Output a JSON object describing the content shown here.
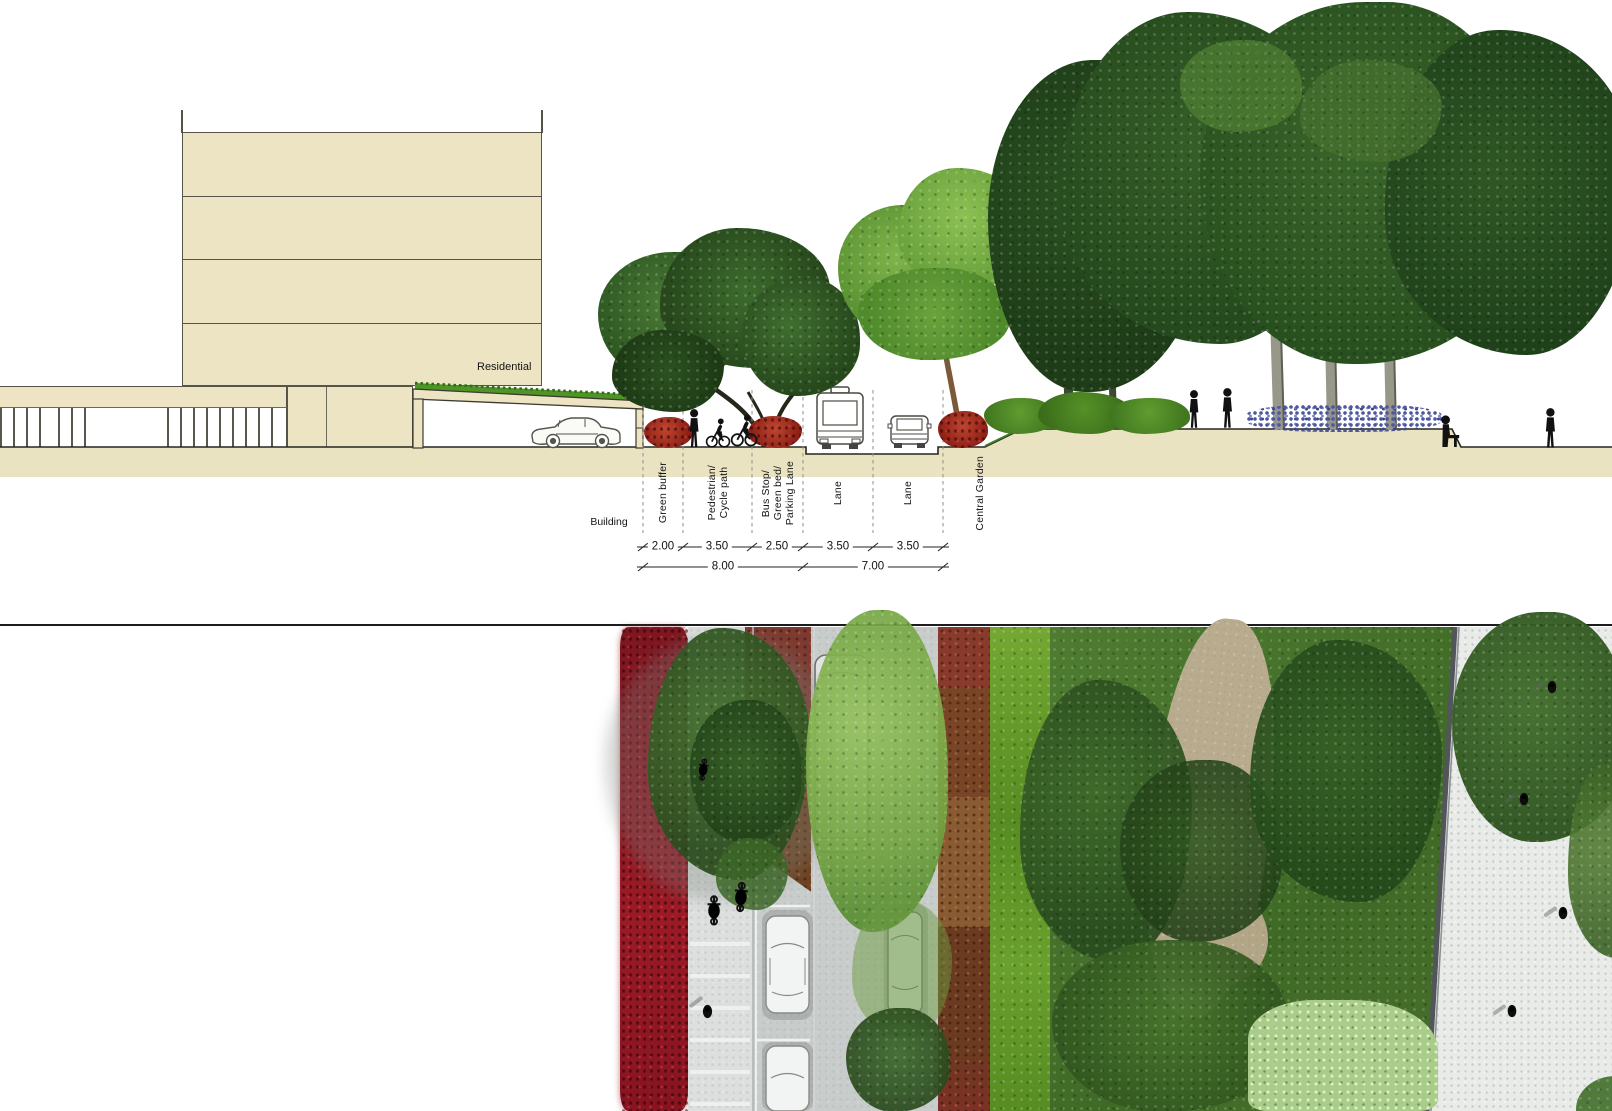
{
  "title": "Street cross-section and plan view",
  "section": {
    "residential_label": "Residential",
    "building_label": "Building",
    "zones": {
      "green_buffer": "Green buffer",
      "ped_line1": "Pedestrian/",
      "ped_line2": "Cycle path",
      "bus_line1": "Bus Stop/",
      "bus_line2": "Green bed/",
      "bus_line3": "Parking Lane",
      "lane_left": "Lane",
      "lane_right": "Lane",
      "central_garden": "Central Garden"
    },
    "dimensions": {
      "green_buffer": "2.00",
      "ped_cycle": "3.50",
      "bus_stop": "2.50",
      "lane_left": "3.50",
      "lane_right": "3.50",
      "total_left": "8.00",
      "total_right": "7.00"
    },
    "units": "m"
  },
  "palette": {
    "building_fill": "#ece4c2",
    "ground_fill": "#eae3c1",
    "drawing_line": "#3c3a31",
    "red_shrub": "#a32126",
    "plan_red_strip": "#8c1620",
    "plan_brown_strip": "#7c4a26",
    "hedge_green": "#74a832",
    "canopy_light": "#8fba58",
    "canopy_mid": "#4e7d2d",
    "canopy_dark": "#2f5526",
    "road_gray": "#c8cccb",
    "path_gray": "#dcdfdd",
    "plaza_gray": "#e9ebe9",
    "tan_path": "#b9ac8e",
    "flower_blue": "#5c66a0",
    "silhouette": "#111111"
  }
}
